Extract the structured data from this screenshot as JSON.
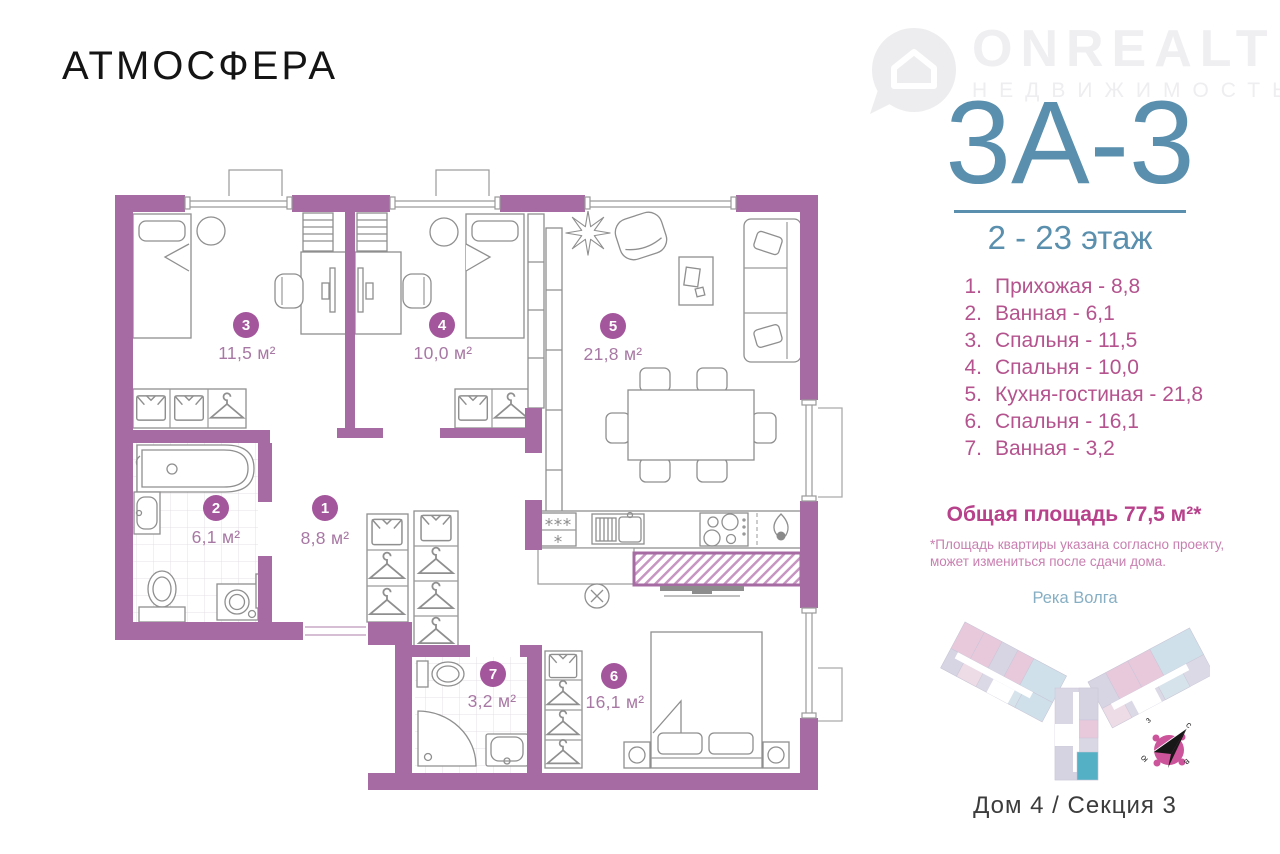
{
  "brand": {
    "name": "АТМОСФЕРА"
  },
  "watermark": {
    "name": "ONREALT",
    "tagline": "НЕДВИЖИМОСТЬ"
  },
  "unit": {
    "code": "3А-3",
    "floors": "2 - 23 этаж"
  },
  "legend": {
    "items": [
      {
        "num": "1.",
        "label": "Прихожая - 8,8"
      },
      {
        "num": "2.",
        "label": "Ванная - 6,1"
      },
      {
        "num": "3.",
        "label": "Спальня - 11,5"
      },
      {
        "num": "4.",
        "label": "Спальня - 10,0"
      },
      {
        "num": "5.",
        "label": "Кухня-гостиная - 21,8"
      },
      {
        "num": "6.",
        "label": "Спальня - 16,1"
      },
      {
        "num": "7.",
        "label": "Ванная - 3,2"
      }
    ]
  },
  "summary": {
    "total": "Общая площадь 77,5 м²*",
    "note1": "*Площадь квартиры указана согласно проекту,",
    "note2": "может измениться после сдачи дома."
  },
  "plan": {
    "rooms": [
      {
        "num": "1",
        "area": "8,8 м²"
      },
      {
        "num": "2",
        "area": "6,1 м²"
      },
      {
        "num": "3",
        "area": "11,5 м²"
      },
      {
        "num": "4",
        "area": "10,0 м²"
      },
      {
        "num": "5",
        "area": "21,8 м²"
      },
      {
        "num": "6",
        "area": "16,1 м²"
      },
      {
        "num": "7",
        "area": "3,2 м²"
      }
    ]
  },
  "minimap": {
    "river": "Река Волга",
    "footer": "Дом 4 / Секция 3",
    "compass": {
      "n": "с",
      "e": "в",
      "s": "ю",
      "w": "з"
    }
  },
  "colors": {
    "wall": "#a66ba3",
    "accent": "#a3569b",
    "teal": "#5a8fad",
    "list_text": "#b4538e",
    "highlight": "#54b1c5"
  }
}
